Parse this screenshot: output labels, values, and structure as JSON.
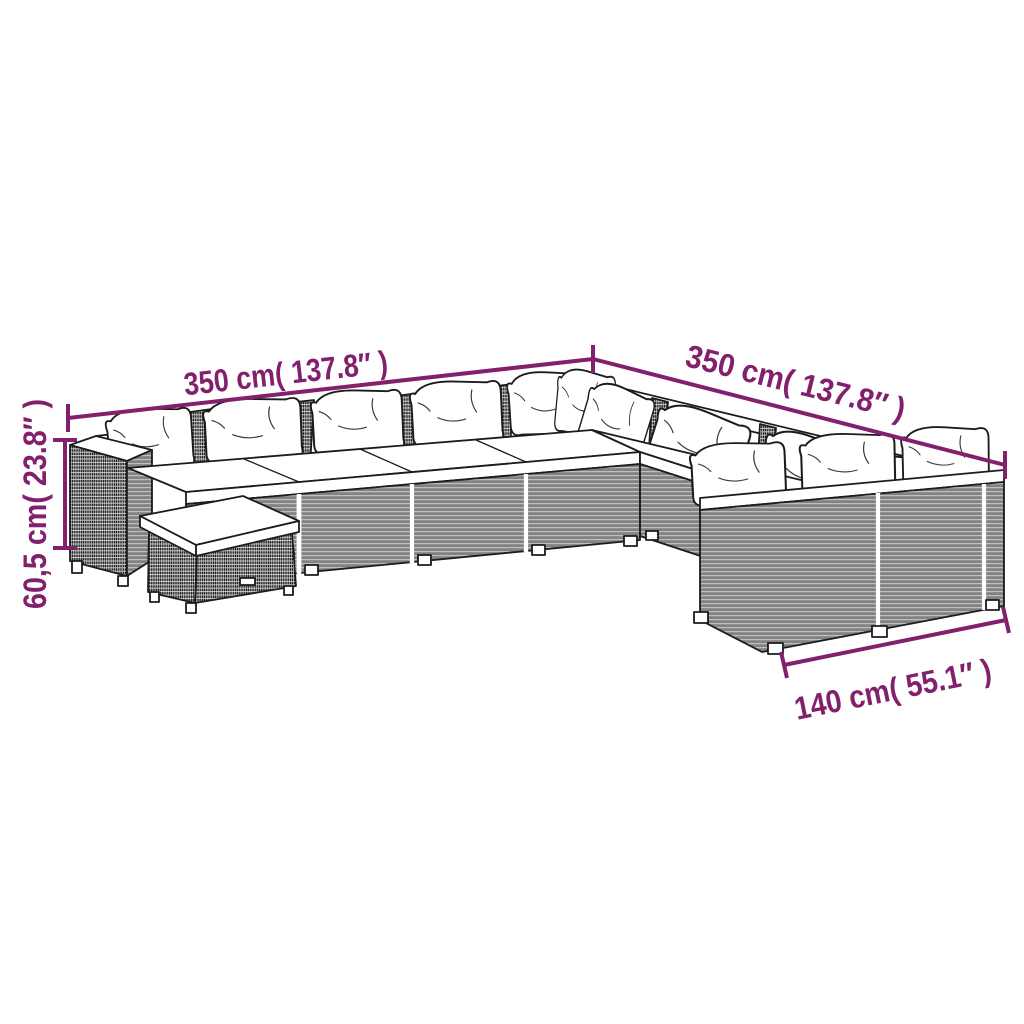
{
  "illustration": {
    "name": "modular-rattan-lounge-set-line-drawing",
    "parts": [
      "left-arm-section",
      "left-wing-seats",
      "corner-section",
      "right-wing-seats",
      "end-section",
      "ottoman",
      "back-pillows",
      "seat-cushions"
    ]
  },
  "dimensions": {
    "top_left": {
      "label": "350 cm( 137.8″ )"
    },
    "top_right": {
      "label": "350 cm( 137.8″ )"
    },
    "left_height": {
      "label": "60,5 cm( 23.8″ )"
    },
    "bottom_right": {
      "label": "140 cm( 55.1″ )"
    }
  },
  "colors": {
    "dimension_accent": "#82206d",
    "line_art": "#1c1c1c",
    "background": "#ffffff",
    "cushions": "#ffffff"
  }
}
